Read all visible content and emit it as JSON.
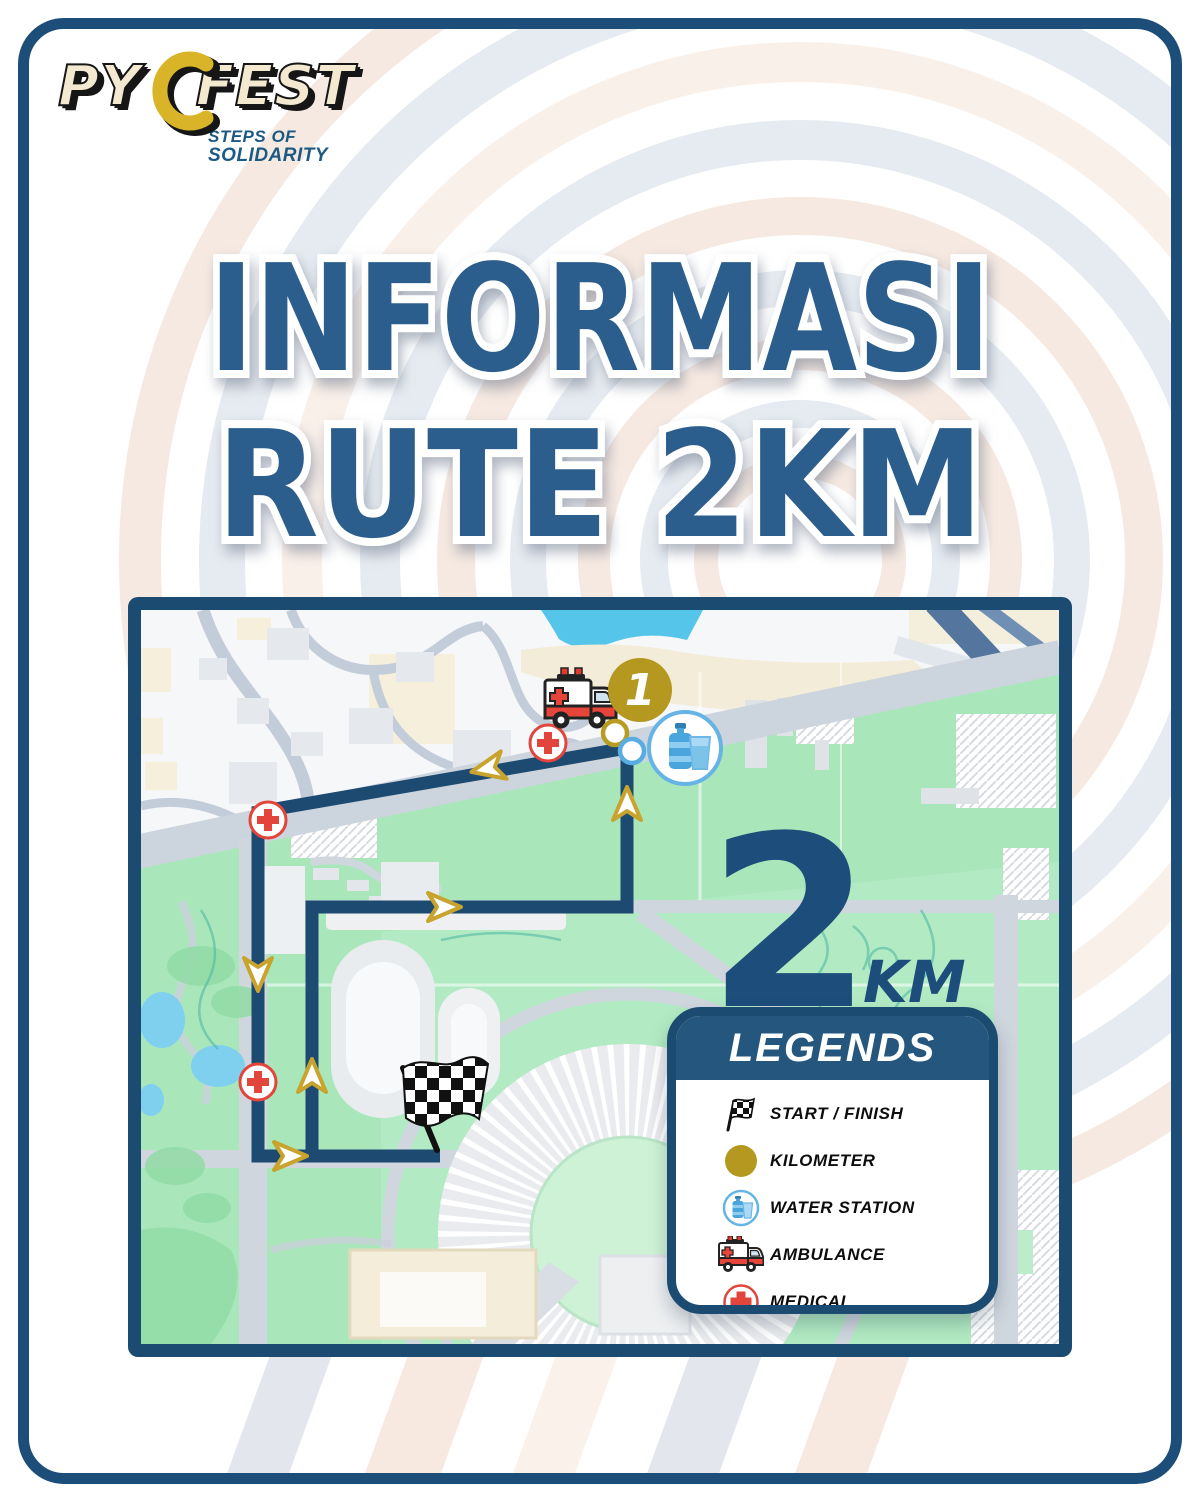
{
  "logo": {
    "word1": "PY",
    "word2": "FEST",
    "tagline_line1": "STEPS OF",
    "tagline_line2": "SOLIDARITY"
  },
  "title": {
    "line1": "INFORMASI",
    "line2": "RUTE 2KM"
  },
  "map": {
    "distance_value": "2",
    "distance_unit": "KM",
    "kilometer_marker_label": "1"
  },
  "legends": {
    "title": "LEGENDS",
    "items": [
      {
        "icon": "start-finish-flag-icon",
        "label": "START / FINISH"
      },
      {
        "icon": "kilometer-icon",
        "label": "KILOMETER"
      },
      {
        "icon": "water-station-icon",
        "label": "WATER STATION"
      },
      {
        "icon": "ambulance-icon",
        "label": "AMBULANCE"
      },
      {
        "icon": "medical-icon",
        "label": "MEDICAL"
      }
    ]
  },
  "colors": {
    "navy": "#1c4b72",
    "title_blue": "#2b5e8c",
    "route_navy": "#1d4a70",
    "gold": "#b89c22",
    "arrow_gold": "#c8a42e",
    "medical_red": "#e1453c",
    "water_blue": "#58ace2",
    "park_green": "#a9e7bb",
    "road_gray": "#ccd4dd",
    "deco_peach": "#f6e9e1",
    "deco_gray": "#e6ebf1"
  }
}
